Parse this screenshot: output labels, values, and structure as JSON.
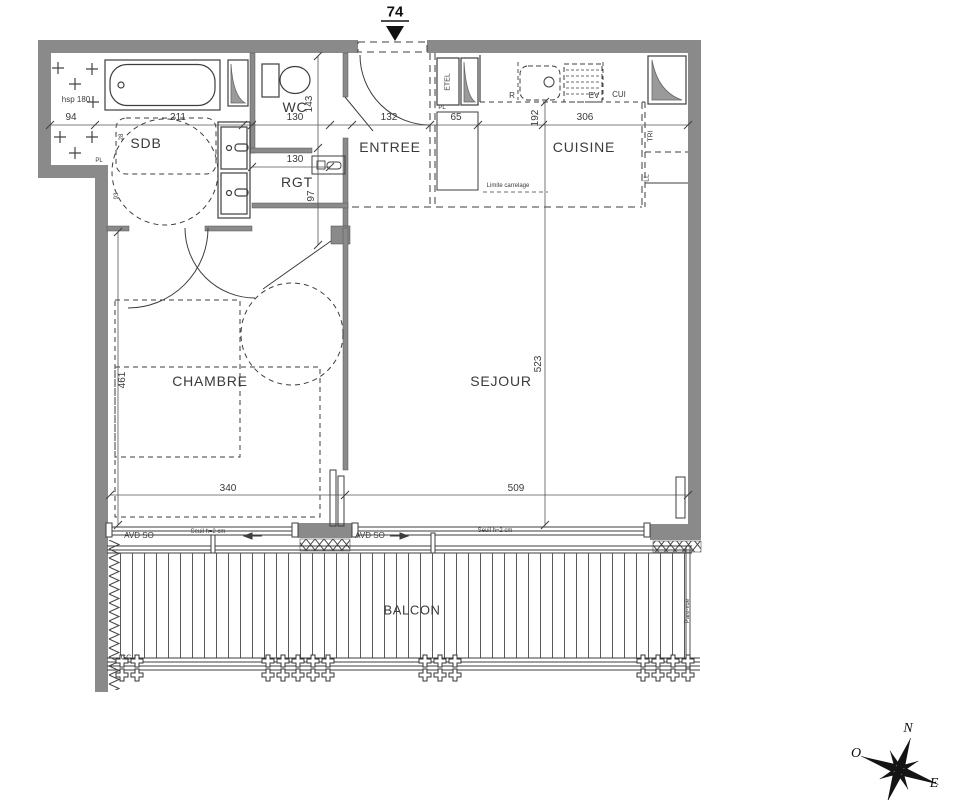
{
  "unit": {
    "number": "74"
  },
  "rooms": {
    "sdb": "SDB",
    "wc": "WC",
    "rgt": "RGT",
    "entree": "ENTREE",
    "cuisine": "CUISINE",
    "chambre": "CHAMBRE",
    "sejour": "SEJOUR",
    "balcon": "BALCON"
  },
  "dims": {
    "sdb_left": "94",
    "sdb_bath": "211",
    "wc_w": "130",
    "wc_d": "143",
    "rgt_w": "130",
    "rgt_d": "97",
    "entree_w": "132",
    "pl_w": "65",
    "cuisine_d": "192",
    "cuisine_w": "306",
    "chambre_d": "461",
    "chambre_w": "340",
    "sejour_d": "523",
    "sejour_w": "509",
    "sdb_door_a": "28",
    "sdb_door_b": "93"
  },
  "labels": {
    "hsp": "hsp 180",
    "pl_left": "PL",
    "pl_kitchen": "PL",
    "etel": "ETEL",
    "fridge": "R",
    "sink": "EV",
    "cooker": "CUI",
    "tri": "TRI",
    "washer": "LL",
    "limite_carrelage": "Limite carrelage",
    "avd_so_left": "AVD SO",
    "avd_so_right": "AVD SO",
    "seuil_left": "Seuil h=2 cm",
    "seuil_right": "Seuil h=2 cm",
    "gc": "GC",
    "pare_vue": "Pare-vue"
  },
  "compass": {
    "north": "N",
    "west": "O",
    "east": "E"
  },
  "colors": {
    "wall": "#8a8a8a",
    "line": "#3e3e3e",
    "background": "#ffffff"
  }
}
